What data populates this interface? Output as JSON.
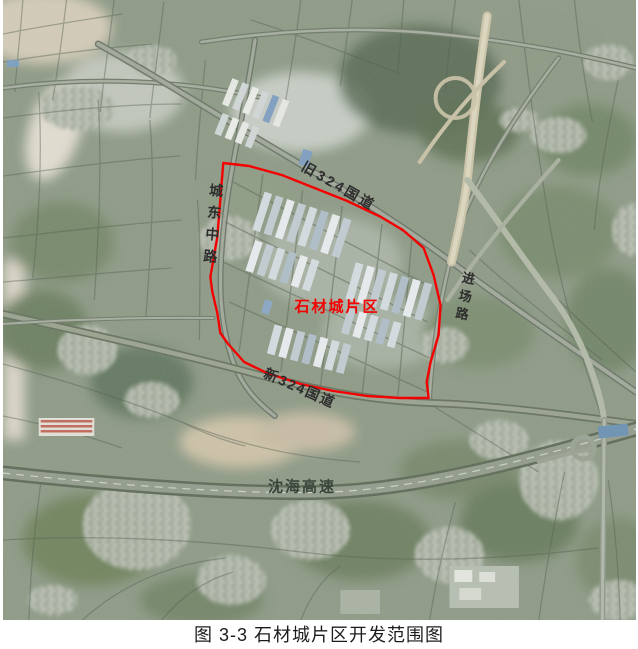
{
  "figure": {
    "caption": "图 3-3 石材城片区开发范围图",
    "caption_color": "#1c1c1c"
  },
  "map": {
    "type": "satellite",
    "area_label": {
      "text": "石材城片区",
      "color": "#f40000"
    },
    "boundary": {
      "color": "#f40000",
      "points": "222,163 248,166 281,175 314,188 347,201 381,217 403,230 424,248 434,275 441,305 439,335 431,362 427,382 429,398 400,398 367,396 333,391 300,384 266,373 243,362 227,344 219,333 216,313 211,292 209,277 216,237 222,163"
    },
    "road_labels": [
      {
        "text": "旧324国道",
        "orientation": "diagonal",
        "color": "#2d2d2d"
      },
      {
        "text": "城东中路",
        "orientation": "vertical",
        "color": "#2d2d2d"
      },
      {
        "text": "进场路",
        "orientation": "vertical",
        "color": "#2d2d2d"
      },
      {
        "text": "新324国道",
        "orientation": "diagonal",
        "color": "#2d2d2d"
      },
      {
        "text": "沈海高速",
        "orientation": "horizontal",
        "color": "#39443b"
      }
    ]
  }
}
